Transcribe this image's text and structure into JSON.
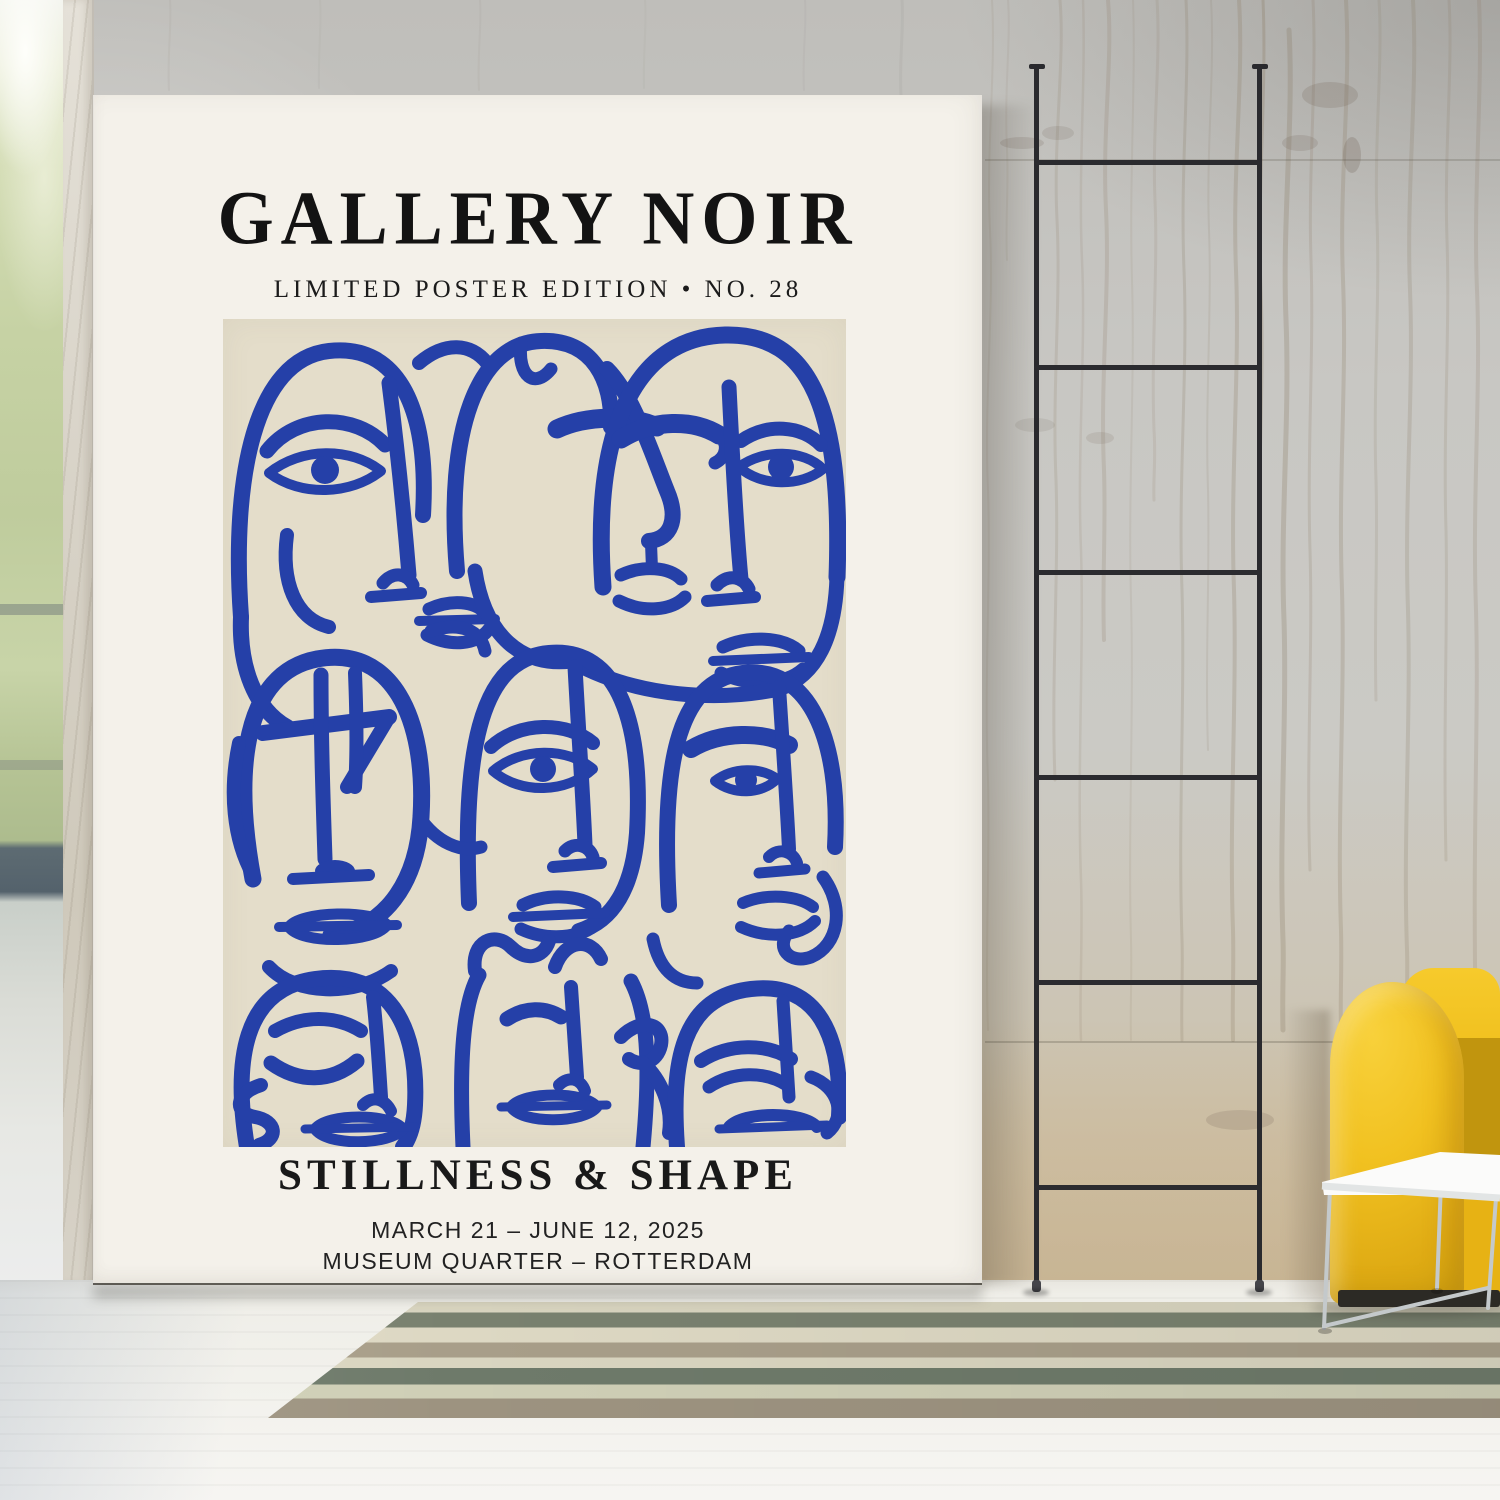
{
  "poster": {
    "gallery_name": "GALLERY NOIR",
    "edition_line": "LIMITED POSTER EDITION • NO. 28",
    "exhibition_title": "STILLNESS & SHAPE",
    "date_range": "MARCH 21 – JUNE 12, 2025",
    "venue": "MUSEUM QUARTER – ROTTERDAM"
  },
  "colors": {
    "artwork_blue": "#2540a8",
    "artwork_background": "#e4ddca",
    "poster_background": "#f4f1ea",
    "chair_yellow": "#f1c120"
  }
}
